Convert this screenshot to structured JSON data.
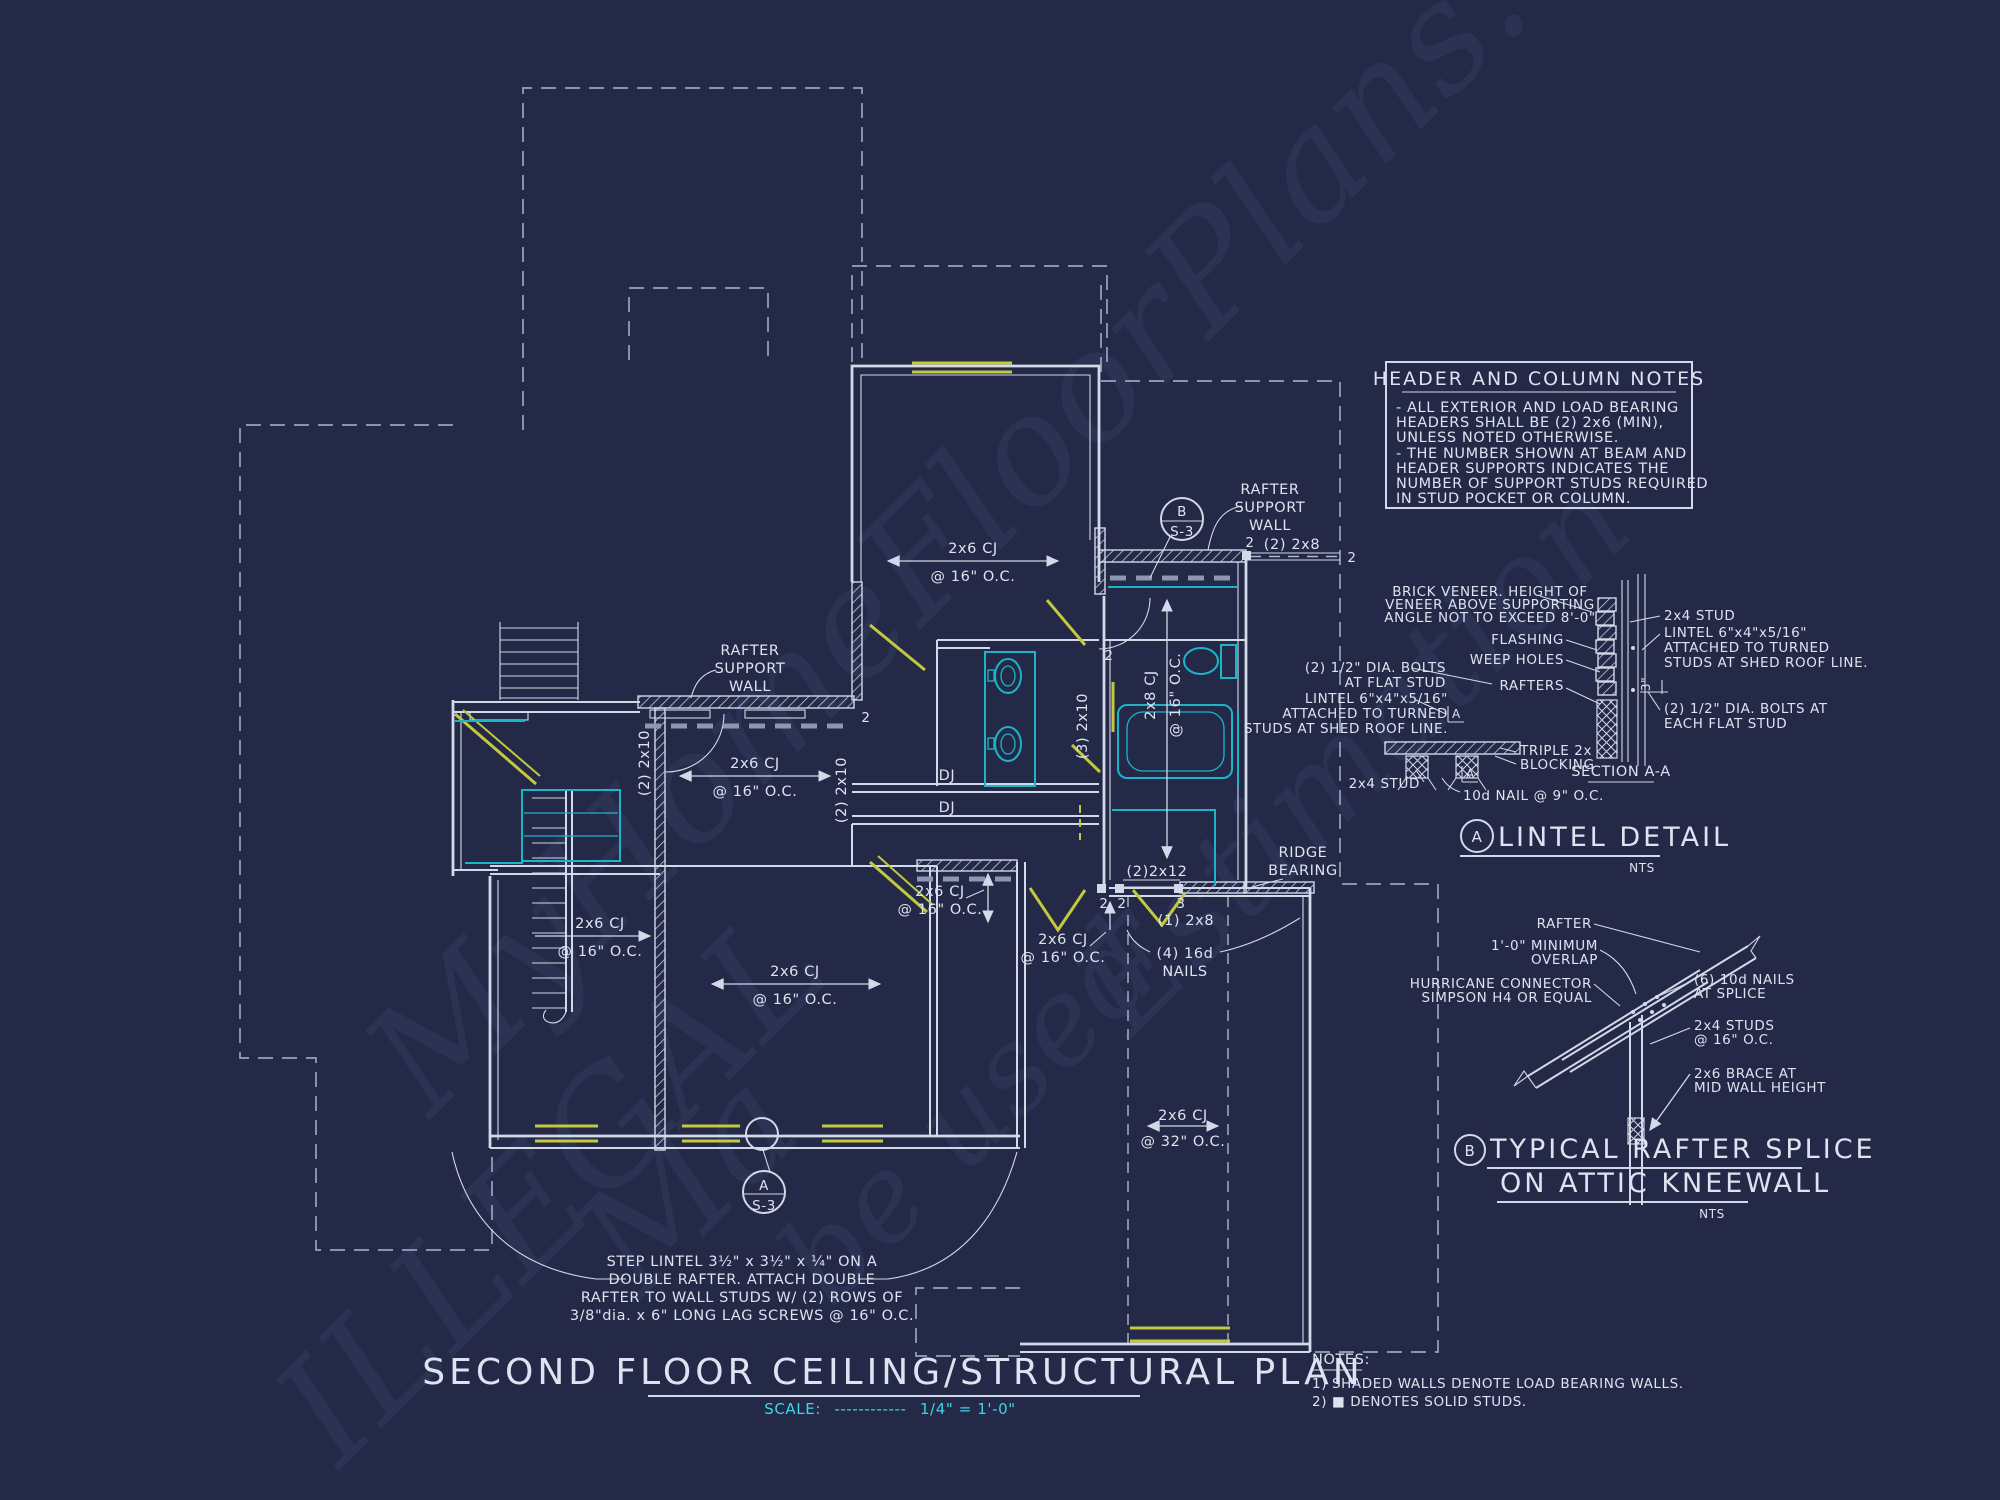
{
  "colors": {
    "background": "#232946",
    "line_white": "#d2d9e8",
    "teal_fixture": "#1ab5c9",
    "cyan_text": "#38d8e8",
    "yellow_header": "#c2c93f",
    "dashed_gray": "#99a3bc",
    "watermark": "#2b3254"
  },
  "watermark": {
    "pieces": [
      "MyHomeFloorPlans.com",
      "ILLEGAL",
      "Ma",
      "be used",
      "Estimation"
    ]
  },
  "title_block": {
    "title": "SECOND FLOOR CEILING/STRUCTURAL PLAN",
    "scale_prefix": "SCALE:",
    "scale_dashes": "------------",
    "scale_value": "1/4\" = 1'-0\""
  },
  "header_notes": {
    "title": "HEADER AND COLUMN NOTES",
    "lines": [
      "- ALL EXTERIOR AND LOAD BEARING",
      "HEADERS SHALL BE (2) 2x6 (MIN),",
      "UNLESS NOTED OTHERWISE.",
      "- THE NUMBER SHOWN AT BEAM AND",
      "HEADER SUPPORTS INDICATES THE",
      "NUMBER OF SUPPORT STUDS REQUIRED",
      "IN STUD POCKET OR COLUMN."
    ]
  },
  "general_notes": {
    "title": "NOTES:",
    "items": [
      "1) SHADED WALLS DENOTE LOAD BEARING WALLS.",
      "2) ■ DENOTES SOLID STUDS."
    ]
  },
  "plan": {
    "rsw1": "RAFTER",
    "rsw2": "SUPPORT",
    "rsw3": "WALL",
    "cj6": "2x6 CJ",
    "oc16": "@ 16\" O.C.",
    "oc32": "@ 32\" O.C.",
    "cj8": "2x8 CJ",
    "dj": "DJ",
    "n2": "2",
    "n3": "3",
    "b2x8": "(2) 2x8",
    "b1x8": "(1) 2x8",
    "b2x10": "(2) 2x10",
    "b3x10": "(3) 2x10",
    "b2x12": "(2)2x12",
    "nails1": "(4) 16d",
    "nails2": "NAILS",
    "ridge1": "RIDGE",
    "ridge2": "BEARING",
    "tagA": "A",
    "tagB": "B",
    "sheet": "S-3",
    "step1": "STEP LINTEL 3½\" x 3½\" x ¼\" ON A",
    "step2": "DOUBLE RAFTER.  ATTACH DOUBLE",
    "step3": "RAFTER TO WALL STUDS W/ (2) ROWS OF",
    "step4": "3/8\"dia. x 6\" LONG LAG SCREWS @ 16\" O.C."
  },
  "lintel": {
    "tag": "A",
    "title": "LINTEL DETAIL",
    "nts": "NTS",
    "secAA": "SECTION A-A",
    "bolts1": "(2) 1/2\" DIA. BOLTS",
    "bolts2": "AT FLAT STUD",
    "lin1": "LINTEL 6\"x4\"x5/16\"",
    "lin2": "ATTACHED TO TURNED",
    "lin3": "STUDS AT SHED ROOF LINE.",
    "brick1": "BRICK VENEER.  HEIGHT OF",
    "brick2": "VENEER ABOVE SUPPORTING",
    "brick3": "ANGLE NOT TO EXCEED 8'-0\"",
    "flashing": "FLASHING",
    "weep": "WEEP HOLES",
    "rafters": "RAFTERS",
    "stud": "2x4 STUD",
    "bolts3": "(2) 1/2\" DIA. BOLTS AT",
    "bolts4": "EACH FLAT STUD",
    "triple1": "TRIPLE 2x",
    "triple2": "BLOCKING",
    "nail9": "10d NAIL @ 9\" O.C.",
    "dim3": "3\"",
    "marker": "A"
  },
  "splice": {
    "tag": "B",
    "title1": "TYPICAL RAFTER SPLICE",
    "title2": "ON ATTIC KNEEWALL",
    "nts": "NTS",
    "rafter": "RAFTER",
    "min1": "1'-0\" MINIMUM",
    "min2": "OVERLAP",
    "hur1": "HURRICANE CONNECTOR",
    "hur2": "SIMPSON H4 OR EQUAL",
    "nails1": "(6) 10d NAILS",
    "nails2": "AT SPLICE",
    "studs1": "2x4 STUDS",
    "studs2": "@ 16\" O.C.",
    "brace1": "2x6 BRACE AT",
    "brace2": "MID WALL HEIGHT"
  }
}
